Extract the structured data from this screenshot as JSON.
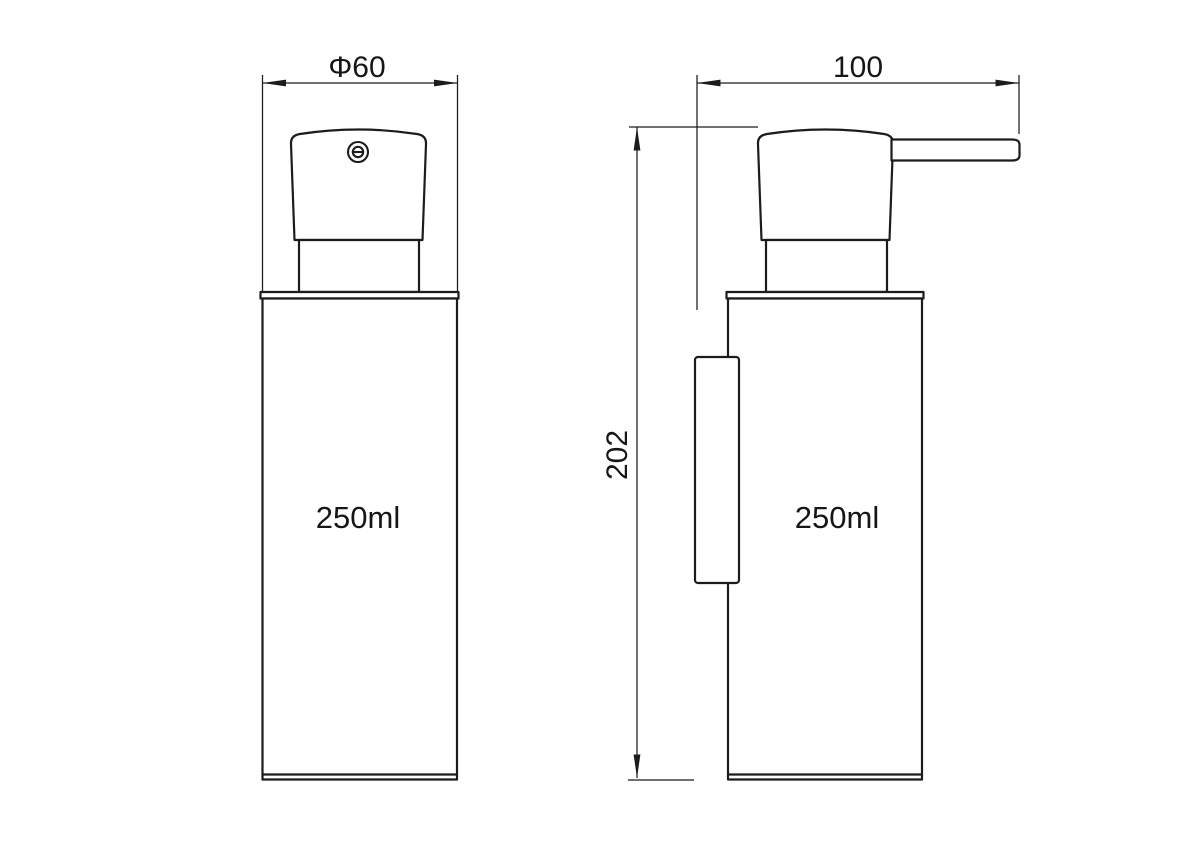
{
  "drawing": {
    "title": "soap dispenser dimension drawing",
    "background_color": "#ffffff",
    "line_color": "#1c1c1c",
    "front_view": {
      "name": "front view",
      "diameter_label": "Φ60",
      "volume_label": "250ml"
    },
    "side_view": {
      "name": "side view",
      "width_label": "100",
      "height_label": "202",
      "volume_label": "250ml"
    }
  }
}
